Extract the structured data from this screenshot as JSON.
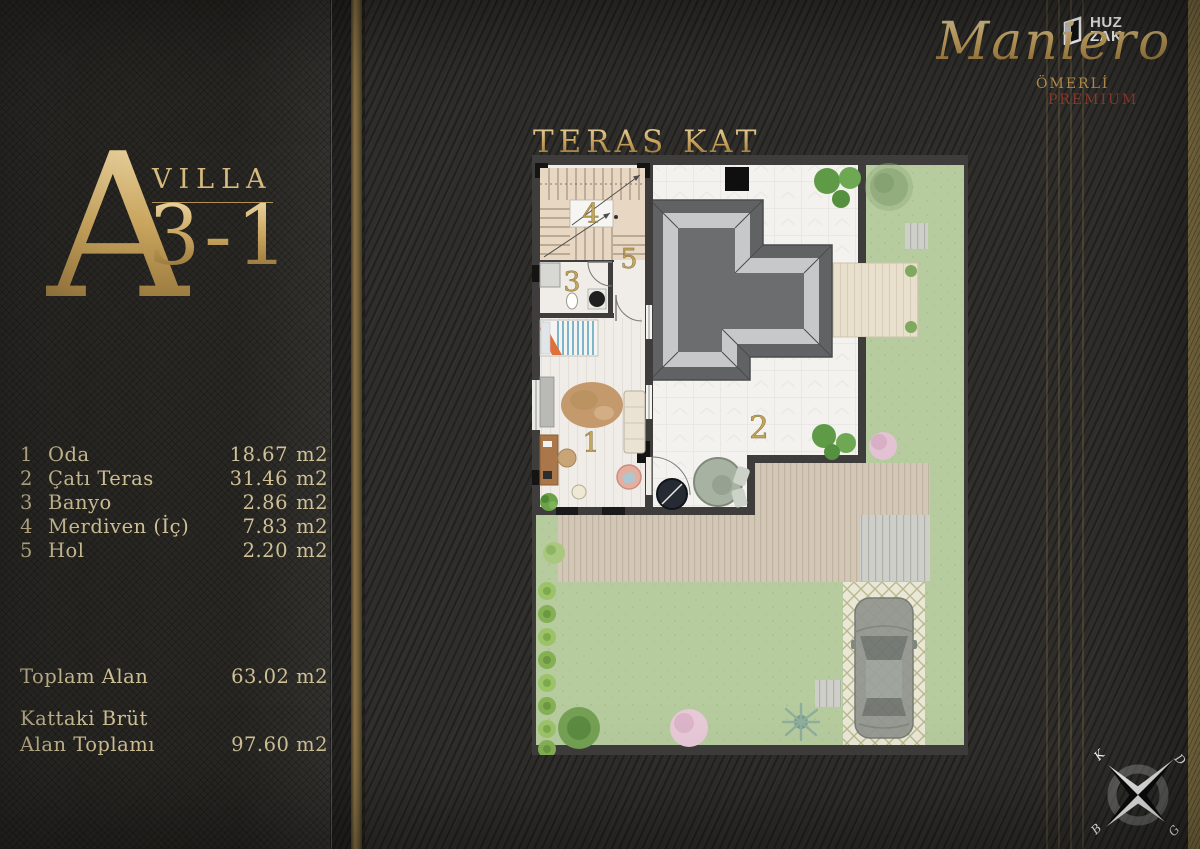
{
  "left_panel": {
    "block_letter": "A",
    "villa_word": "VILLA",
    "villa_number": "3-1",
    "rooms": [
      {
        "no": "1",
        "name": "Oda",
        "value": "18.67",
        "unit": "m2"
      },
      {
        "no": "2",
        "name": "Çatı Teras",
        "value": "31.46",
        "unit": "m2"
      },
      {
        "no": "3",
        "name": "Banyo",
        "value": "2.86",
        "unit": "m2"
      },
      {
        "no": "4",
        "name": "Merdiven (İç)",
        "value": "7.83",
        "unit": "m2"
      },
      {
        "no": "5",
        "name": "Hol",
        "value": "2.20",
        "unit": "m2"
      }
    ],
    "total": {
      "label": "Toplam Alan",
      "value": "63.02 m2"
    },
    "gross": {
      "label_line1": "Kattaki Brüt",
      "label_line2": "Alan Toplamı",
      "value": "97.60 m2"
    }
  },
  "brand": {
    "logo_top": "HUZ",
    "logo_bottom": "ZAK",
    "name": "Maniero",
    "location": "ÖMERLİ",
    "tier": "PREMIUM"
  },
  "plan": {
    "title": "TERAS KAT",
    "labels": {
      "room1": "1",
      "room2": "2",
      "room3": "3",
      "room4": "4",
      "room5": "5"
    }
  },
  "compass": {
    "north": "K",
    "east": "D",
    "south": "G",
    "west": "B"
  },
  "colors": {
    "gold": "#c9a55e",
    "cream_gold": "#cfc096",
    "premium_red": "#8d3a2e",
    "background": "#2e2d2a"
  }
}
